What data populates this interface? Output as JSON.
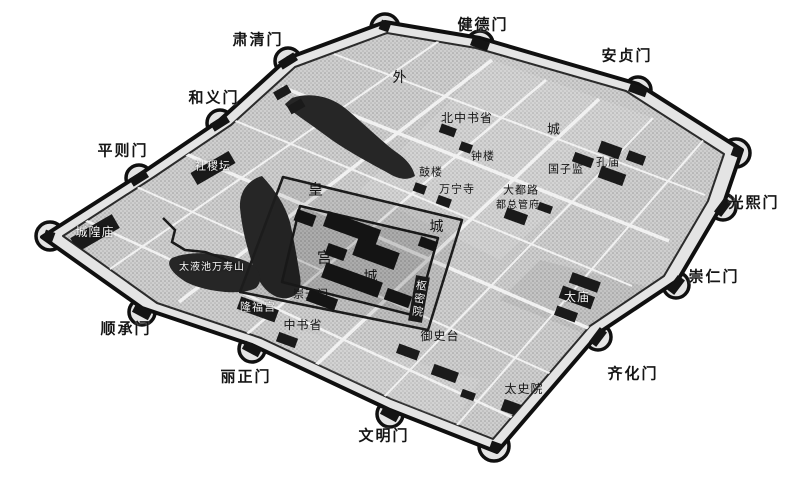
{
  "map": {
    "description": "Bird's-eye perspective map of the walled city of Yuan Dadu with outer city wall, gate bastions, street grid, lakes, imperial city and palace city",
    "colors": {
      "background": "#ffffff",
      "wall_outline": "#101010",
      "wall_band": "#e4e4e4",
      "city_ground": "#cfcfcf",
      "water": "#262626",
      "building_block": "#161616",
      "street": "#f1f1f1",
      "label_dark": "#151515",
      "label_light": "#f7f7f7"
    }
  },
  "labels": {
    "gates": {
      "suqingmen": "肃清门",
      "jiandemen": "健德门",
      "anzhenmen": "安贞门",
      "heyimen": "和义门",
      "pingzemen": "平则门",
      "guangximen": "光熙门",
      "chongrenmen": "崇仁门",
      "qihuamen": "齐化门",
      "shunchengmen": "顺承门",
      "lizhengmen": "丽正门",
      "wenmingmen": "文明门"
    },
    "districts": {
      "wai": "外",
      "cheng_outer": "城",
      "huang": "皇",
      "cheng_imperial": "城",
      "gong": "宫",
      "cheng_palace": "城"
    },
    "sites": {
      "beizhongshusheng": "北中书省",
      "zhonglou": "钟楼",
      "kongmiao": "孔庙",
      "guozijian": "国子监",
      "gulou": "鼓楼",
      "wanningsi": "万宁寺",
      "dadulu": "大都路",
      "duzongguanfu": "都总管府",
      "chongtianmen": "崇天门",
      "longfugong": "隆福宫",
      "zhongshusheng": "中书省",
      "shumiyuan": "枢密院",
      "yushitai": "御史台",
      "taimiao": "太庙",
      "taishiyuan": "太史院",
      "chenghuangmiao": "城隍庙",
      "shejitan": "社稷坛",
      "taiyechi_wanshoushan": "太液池万寿山"
    }
  }
}
